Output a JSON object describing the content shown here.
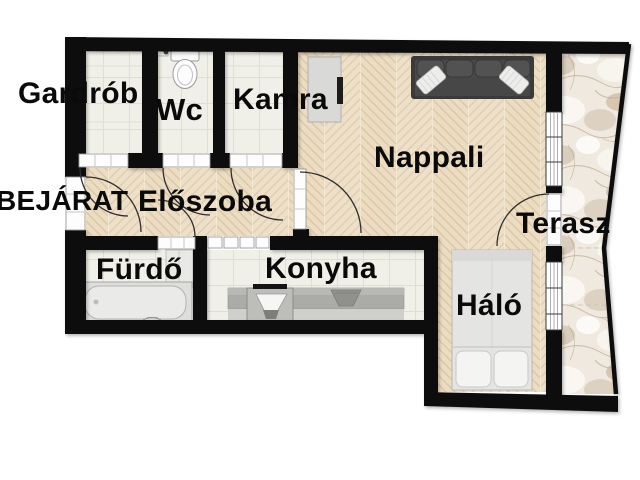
{
  "title": "Apartment floor plan",
  "rooms": {
    "gardrob": {
      "label": "Gardrób"
    },
    "wc": {
      "label": "Wc"
    },
    "kamra": {
      "label": "Kamra"
    },
    "nappali": {
      "label": "Nappali"
    },
    "eloszoba": {
      "label": "Előszoba"
    },
    "furdo": {
      "label": "Fürdő"
    },
    "konyha": {
      "label": "Konyha"
    },
    "halo": {
      "label": "Háló"
    },
    "terasz": {
      "label": "Terasz"
    }
  },
  "entrance": {
    "label": "BEJÁRAT"
  },
  "furniture": {
    "sofa": "sofa",
    "tv_cabinet": "tv-cabinet",
    "toilet": "toilet",
    "bathtub": "bathtub",
    "washbasin": "washbasin",
    "kitchen_counter": "kitchen-counter",
    "kitchen_sink": "kitchen-sink",
    "stove": "stove",
    "bed": "double-bed"
  },
  "colors": {
    "wall": "#0e0e0e",
    "wood_floor": "#ecdcc2",
    "tile_floor": "#f1f0e8",
    "terrace_marble": "#efe9df",
    "label_text": "#0a0a0a",
    "background": "#ffffff"
  }
}
